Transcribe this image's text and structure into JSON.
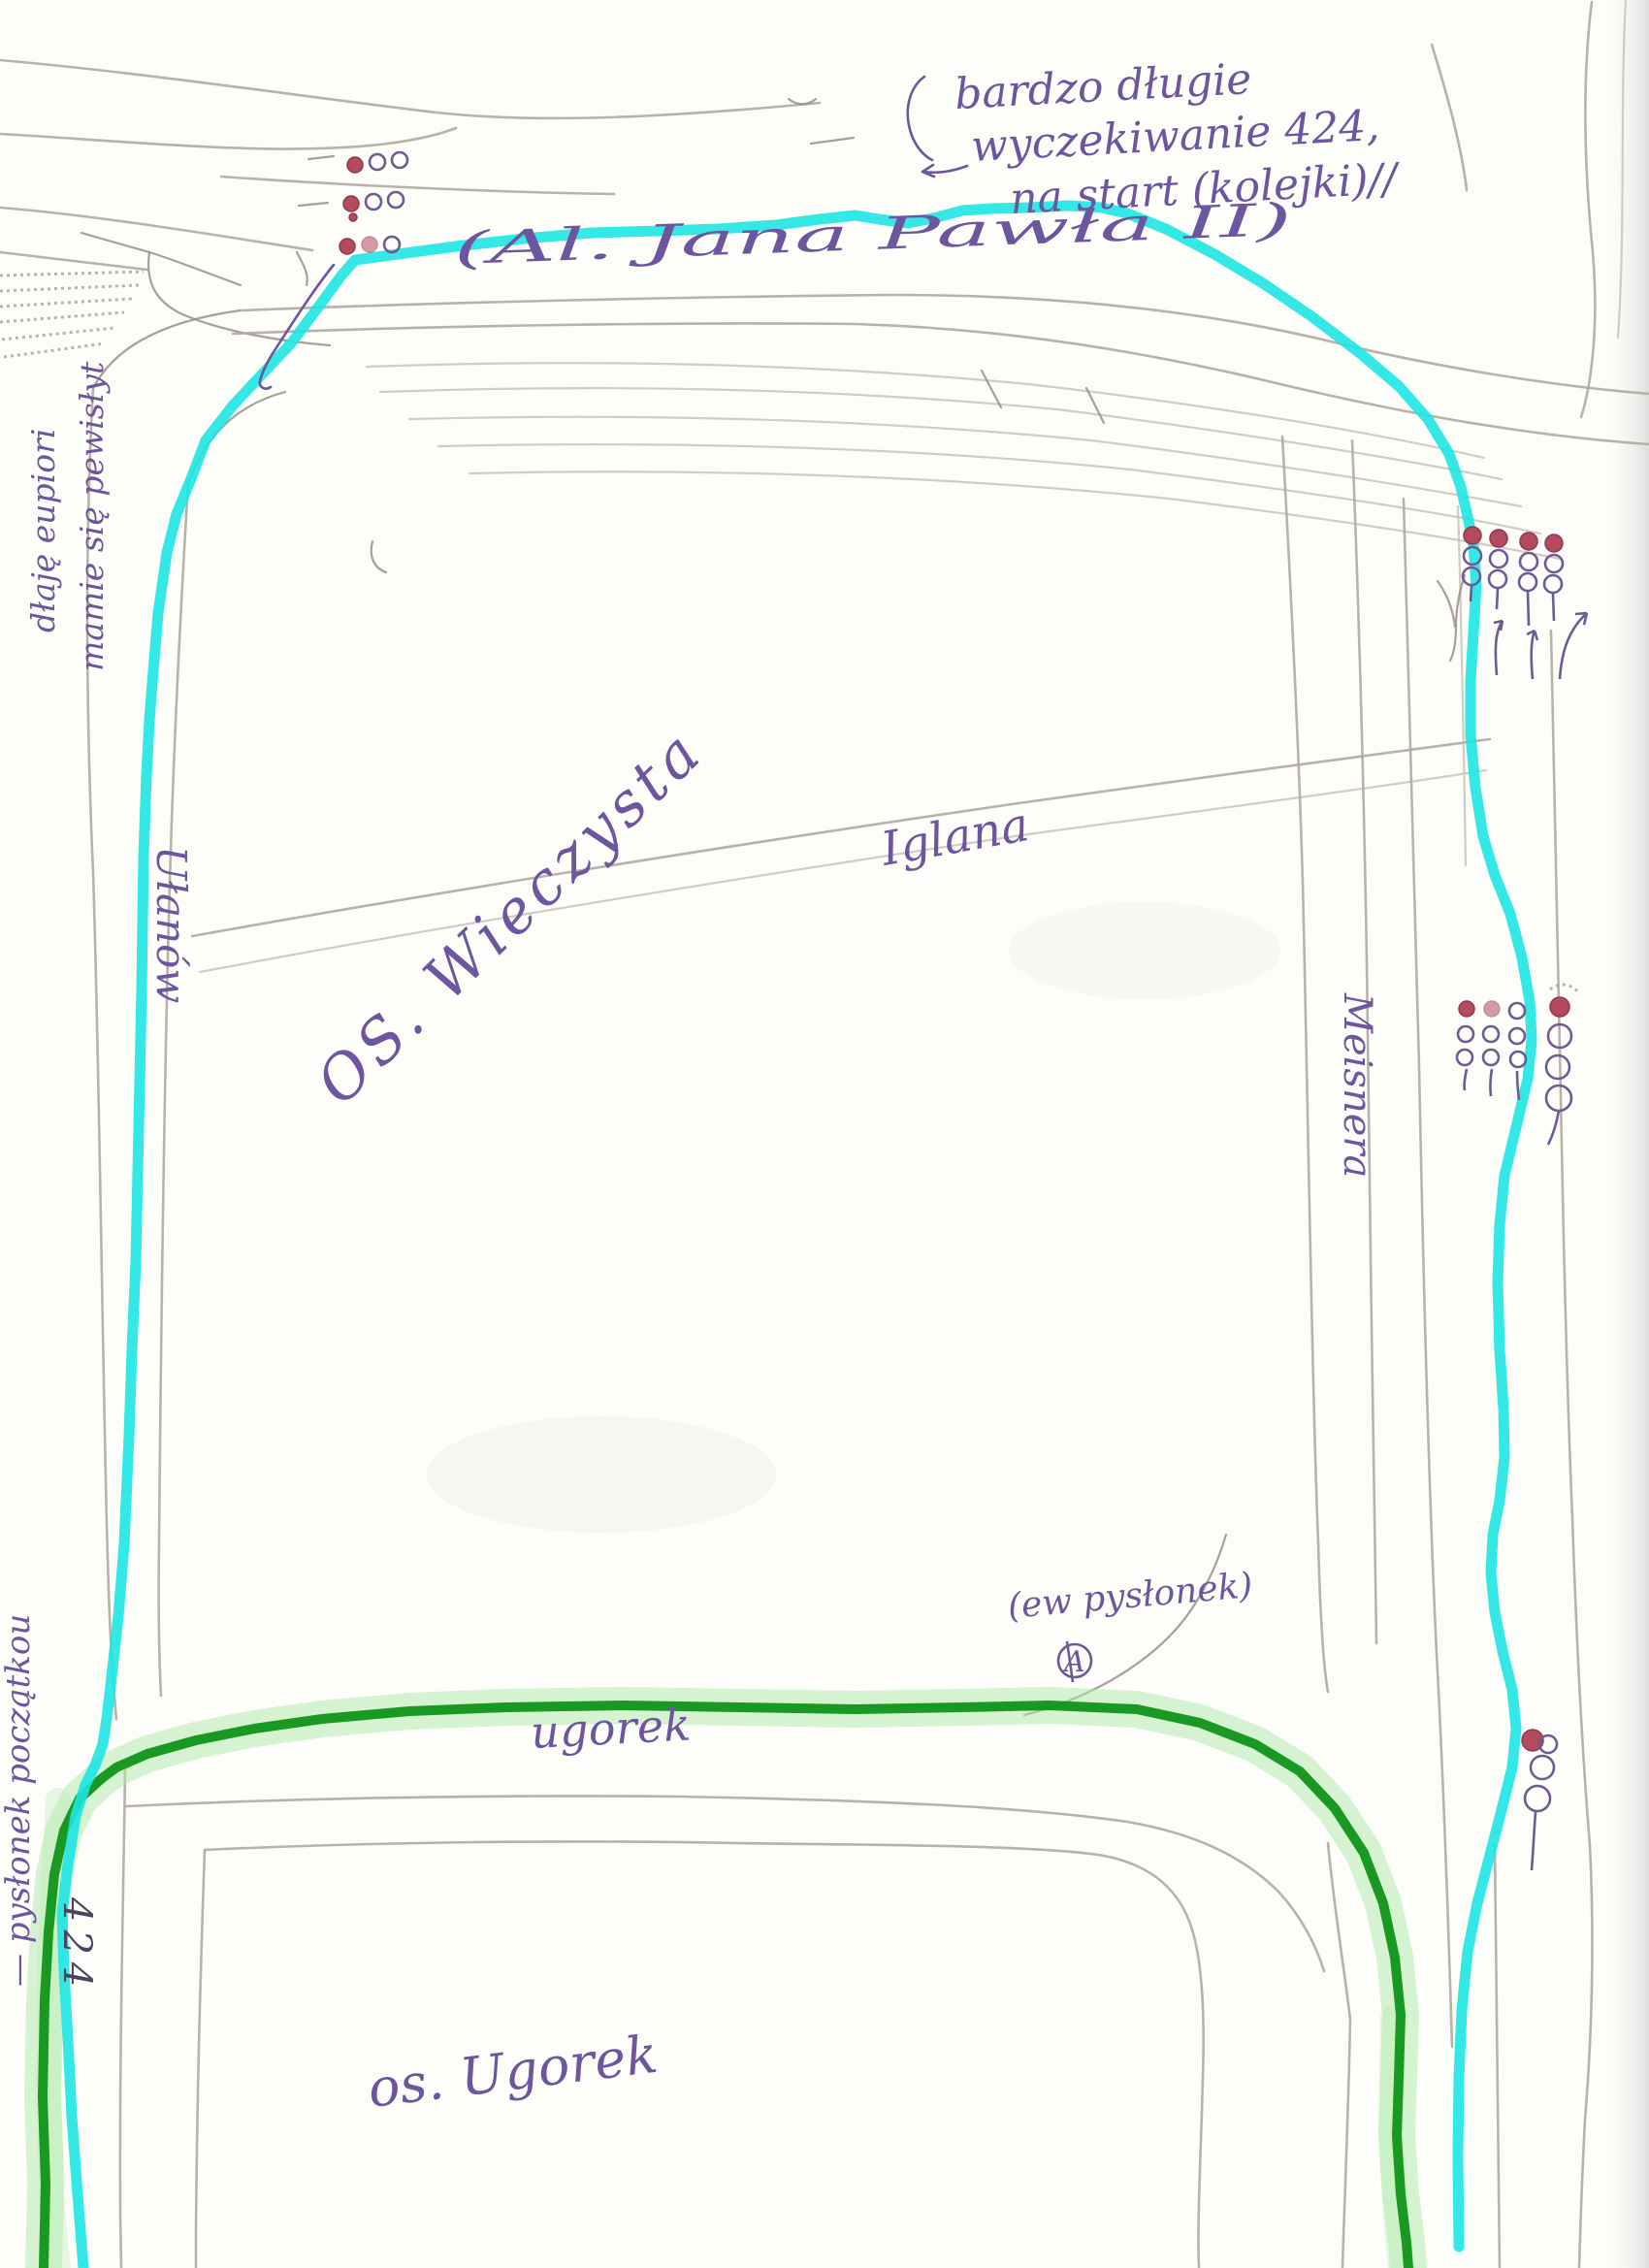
{
  "document": {
    "kind": "hand-drawn transit route sketch on scanned paper",
    "routes": {
      "highlighted_route_1": "cyan marker line along Al. Jana Pawła II / Ułanów / east side",
      "highlighted_route_2": "dark green marker line with light green halo along ugorek street"
    }
  },
  "colors": {
    "paper": "#fdfdfa",
    "route_cyan": "#1de6e2",
    "route_green": "#0f9318",
    "route_green_halo": "#aeeaa8",
    "pencil": "#b3aaa0",
    "ink_violet": "#6d569f",
    "signal_red": "#b34a5e"
  },
  "icons": {
    "traffic_light_icon": "stack of three small circles, top circle filled red",
    "direction_arrow_icon": "hand-drawn upward arrows at junction",
    "stop_marker_a_icon": "letter A inside a circle"
  },
  "labels": {
    "note_top_right_line1": "bardzo długie",
    "note_top_right_line2": "wyczekiwanie 424,",
    "note_top_right_line3": "na start (kolejki)//",
    "street_al_jana_pawla": "(Al. Jana Pawła II)",
    "note_top_left_line1": "dłaję eupiori",
    "note_top_left_line2": "mamie się pewisłyt",
    "street_ulanow": "Ułanów",
    "district_wieczysta": "OS. Wieczysta",
    "street_center": "Iglana",
    "street_meissnera": "Meisnera",
    "note_possible_stop": "(ew pysłonek)",
    "marker_a": "A",
    "street_ugorek": "ugorek",
    "district_ugorek": "os. Ugorek",
    "note_start_stop": "— pysłonek początkou",
    "route_number": "424"
  }
}
